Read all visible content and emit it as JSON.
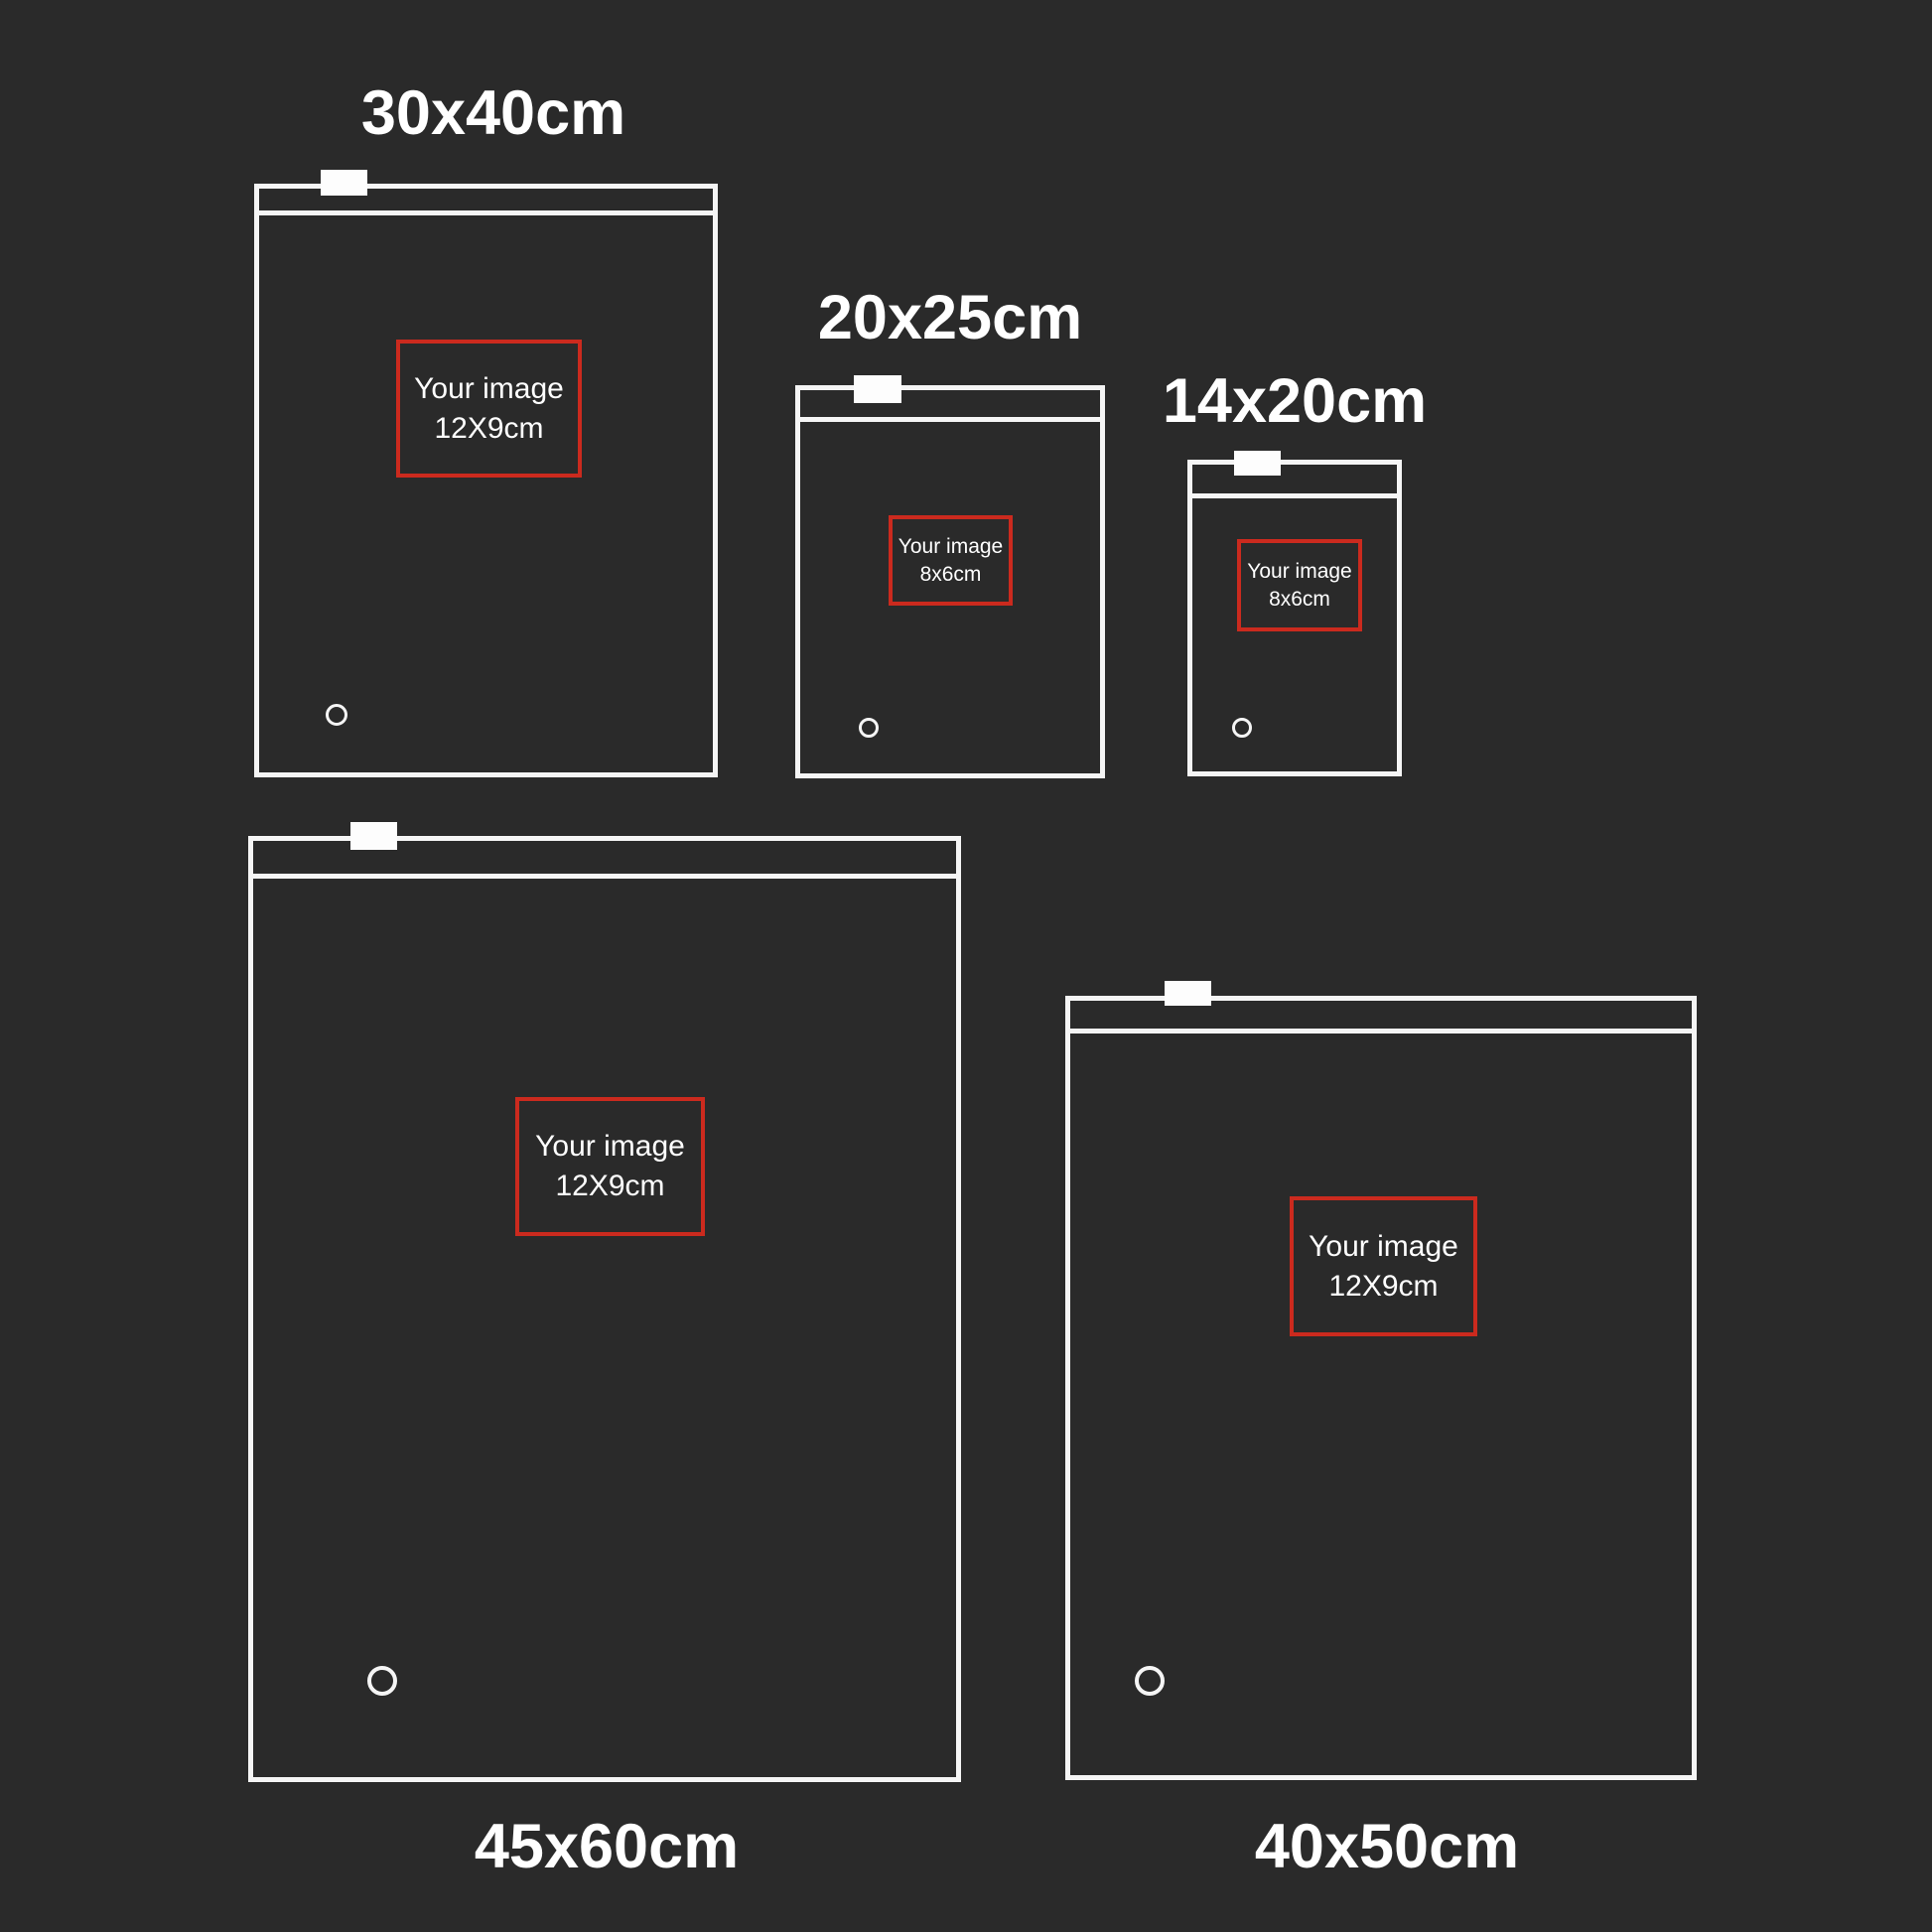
{
  "title": "Zipper bag size comparison",
  "colors": {
    "background": "#2a2a2a",
    "line_white": "#f5f5f5",
    "print_area_red": "#cb2a1e",
    "text": "#ffffff"
  },
  "bags": [
    {
      "id": "30x40",
      "label": "30x40cm",
      "label_position": "top",
      "image_box": {
        "line1": "Your image",
        "line2": "12X9cm"
      }
    },
    {
      "id": "20x25",
      "label": "20x25cm",
      "label_position": "top",
      "image_box": {
        "line1": "Your image",
        "line2": "8x6cm"
      }
    },
    {
      "id": "14x20",
      "label": "14x20cm",
      "label_position": "top",
      "image_box": {
        "line1": "Your image",
        "line2": "8x6cm"
      }
    },
    {
      "id": "45x60",
      "label": "45x60cm",
      "label_position": "bottom",
      "image_box": {
        "line1": "Your image",
        "line2": "12X9cm"
      }
    },
    {
      "id": "40x50",
      "label": "40x50cm",
      "label_position": "bottom",
      "image_box": {
        "line1": "Your image",
        "line2": "12X9cm"
      }
    }
  ]
}
